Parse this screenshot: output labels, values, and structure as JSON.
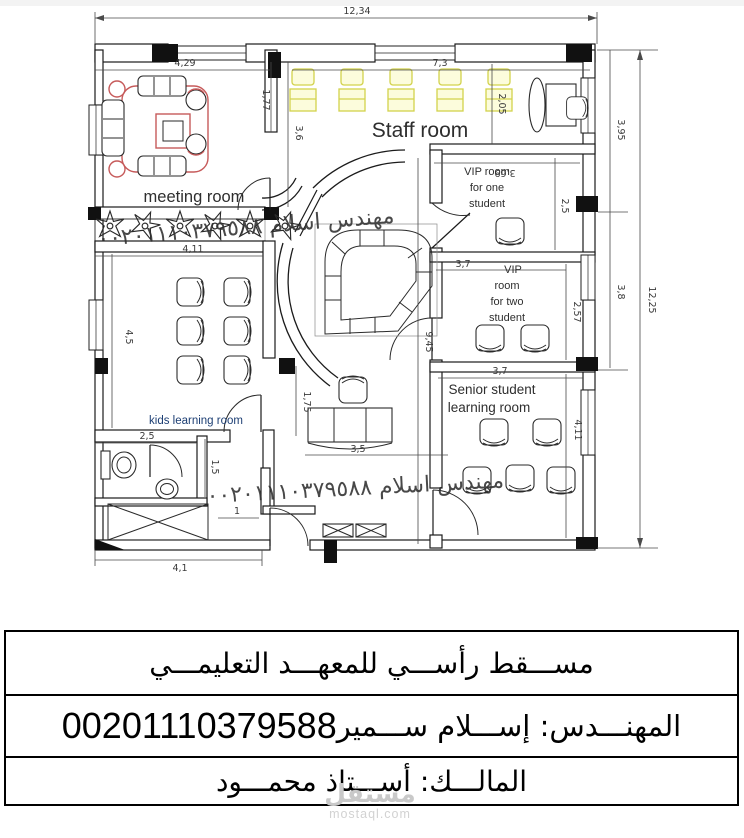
{
  "plan": {
    "rooms": {
      "staff": {
        "label": "Staff room"
      },
      "meeting": {
        "label": "meeting room"
      },
      "kids": {
        "label": "kids learning room"
      },
      "vip1": {
        "l1": "VIP room",
        "l2": "for one",
        "l3": "student"
      },
      "vip2": {
        "l1": "VIP",
        "l2": "room",
        "l3": "for two",
        "l4": "student"
      },
      "senior": {
        "l1": "Senior student",
        "l2": "learning room"
      }
    },
    "dims": {
      "total_width": "12,34",
      "total_height": "12,25",
      "meeting_width": "4,29",
      "meeting_height": "3,6",
      "wall_gap": "1,77",
      "staff_width": "7,3",
      "staff_depth": "2,05",
      "vip1_width": "3,69",
      "vip1_height": "2,5",
      "vip2_width": "3,7",
      "vip2_height": "2,57",
      "right_upper": "3,95",
      "right_lower": "3,8",
      "senior_width": "3,7",
      "senior_height": "4,11",
      "kids_width": "4,11",
      "kids_height": "4,5",
      "hall_depth": "9,45",
      "desk_width": "3,5",
      "desk_offset": "1,75",
      "wc_width": "2,5",
      "wc_depth": "1,5",
      "door_width": "1",
      "bottom_width": "4,1"
    },
    "colors": {
      "furniture_accent": "#c65a5a",
      "staff_desk_yellow": "#d2d24c",
      "kids_label_blue": "#1c3e73"
    }
  },
  "watermarks": {
    "engineer_diagonal": "مهندس اسلام ٠٠٢٠١١١٠٣٧٩٥٨٨",
    "engineer_horizontal": "مهندس اسلام ٠٠٢٠١١١٠٣٧٩٥٨٨",
    "logo_name": "مستقل",
    "logo_domain": "mostaql.com"
  },
  "title_block": {
    "row1": "مســـقط رأســـي للمعهـــد التعليمـــي",
    "row2_label": "المهنـــدس: إســـلام ســـمير",
    "row2_number": "00201110379588",
    "row3": "المالـــك: أســـتاذ محمـــود"
  }
}
